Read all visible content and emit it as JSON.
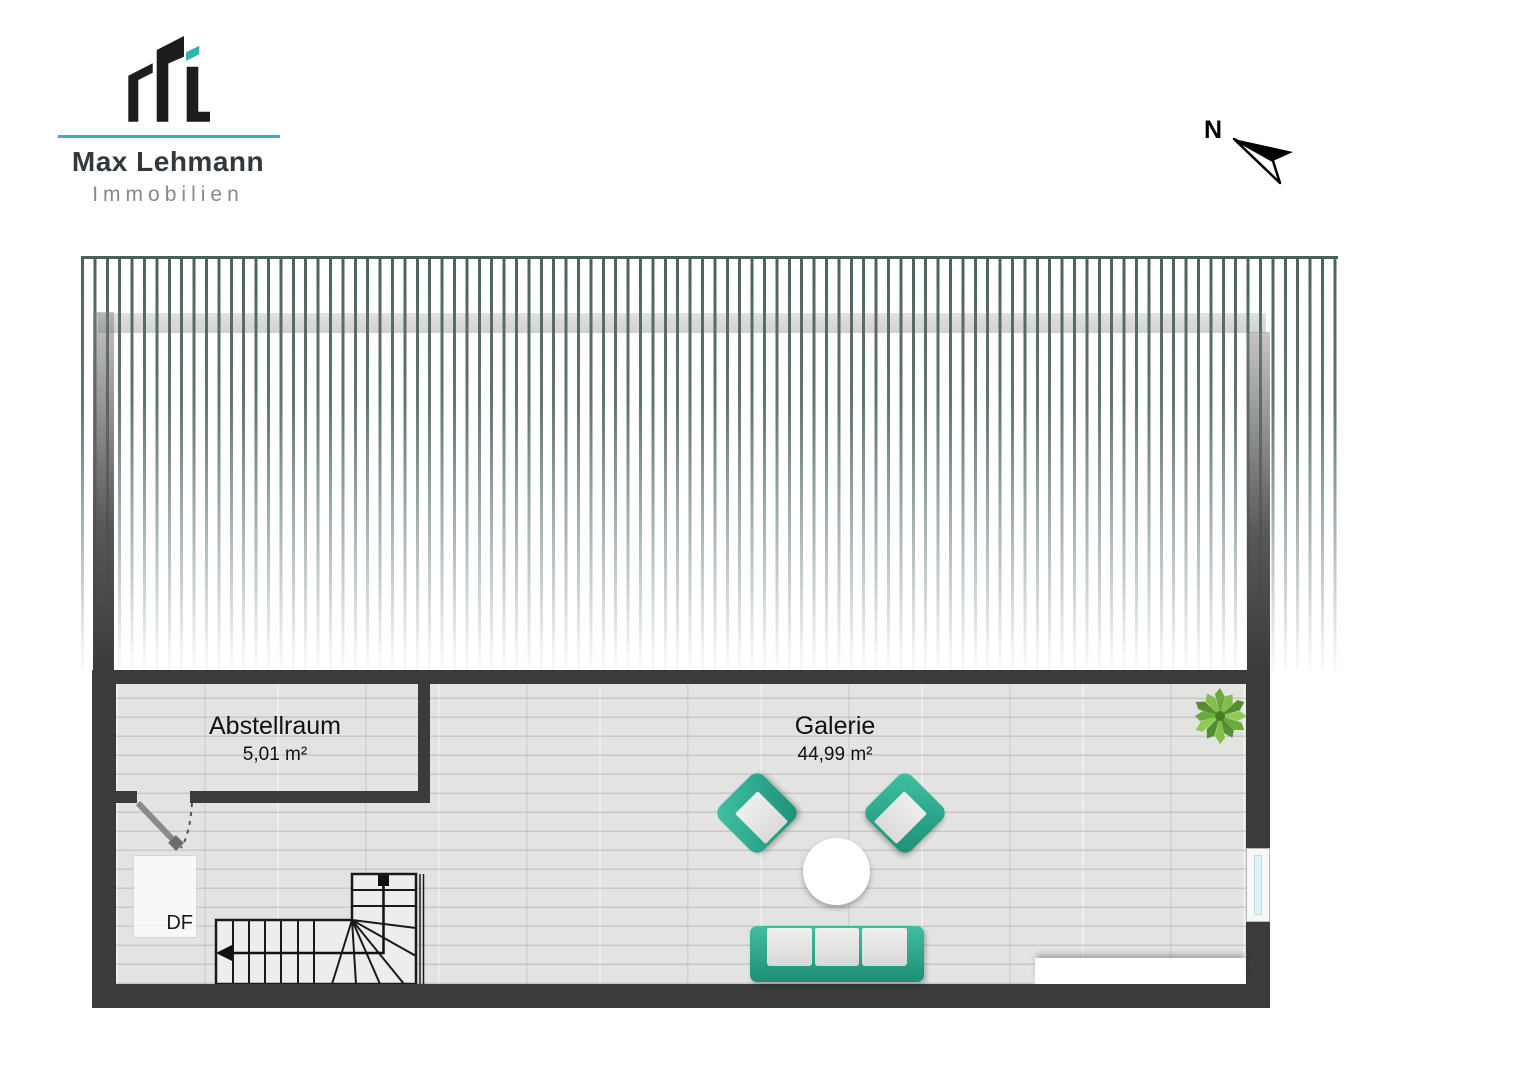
{
  "brand": {
    "company": "Max Lehmann",
    "tagline": "Immobilien"
  },
  "compass": {
    "north_label": "N"
  },
  "floor_plan": {
    "floor_name": "Dachgeschoss-Galerie",
    "rooms": [
      {
        "name": "Abstellraum",
        "area": "5,01 m²"
      },
      {
        "name": "Galerie",
        "area": "44,99 m²"
      }
    ],
    "labels": {
      "roof_window": "DF"
    }
  },
  "colors": {
    "accent_teal": "#2fb3b5",
    "wall_dark": "#3b3b3b",
    "roof_hatch_green": "#4a645c",
    "furniture_teal": "#2aa68c",
    "floor_gray": "#e3e3e1",
    "window_glass": "#d9f2f6",
    "plant_green": "#6aa93c"
  }
}
